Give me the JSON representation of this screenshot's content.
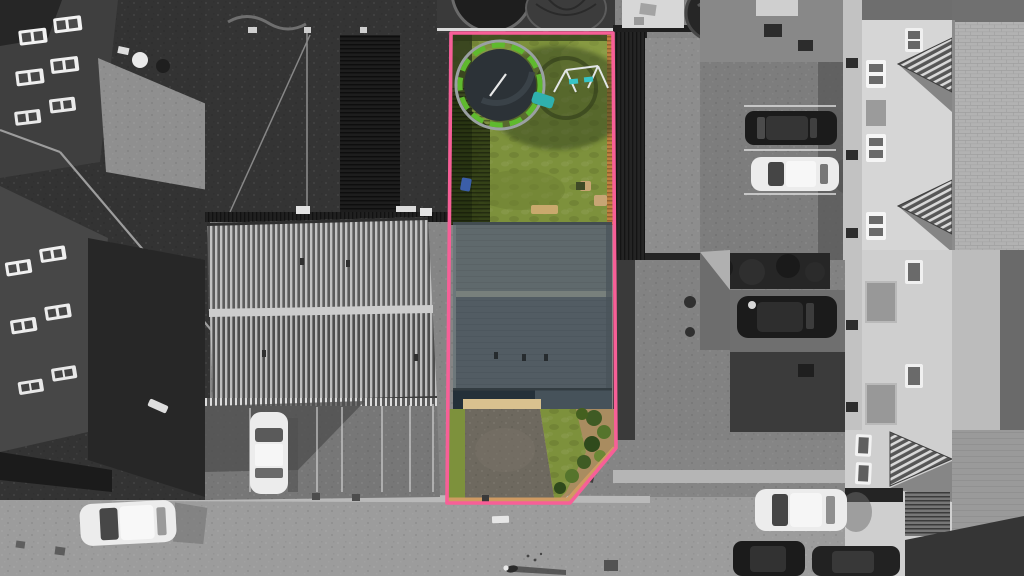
{
  "meta": {
    "kind": "aerial-drone-photograph",
    "description": "Overhead estate-agent style drone photo of a terraced property; the subject plot is outlined in pink and shown in colour while all surroundings are desaturated greyscale.",
    "visible_text": ""
  },
  "scene": {
    "elements": [
      "pink property boundary outline with bevelled front corner",
      "green rear lawn with trampoline, toy slide and swing set",
      "slate grey pitched house roof with three roof vents",
      "tarmac driveway flanked by grass and a shrub bed with tan brick edging",
      "large corrugated-roof outbuilding left of plot",
      "neighbouring grey lawn, decking and hot tub right of plot",
      "parking bays with one dark and one white car (right)",
      "parking bays with white car under building shadow (left)",
      "gable-fronted houses with striped dormer roofs (right)",
      "dark brick houses with white windows (left)",
      "bottom road with two white cars, two dark cars, manhole and a pedestrian casting a long shadow",
      "timber fences and their slatted shadows"
    ],
    "cars": {
      "white": 4,
      "dark": 4
    },
    "pedestrians": 1
  },
  "colors": {
    "boundary": "#f75f97",
    "lawn": "#7d913c",
    "lawn_shadow": "#3f4a24",
    "trampoline_rim": "#5fb92e",
    "trampoline_mat": "#2c3237",
    "trampoline_ring": "#9aa0a2",
    "slide_teal": "#2fb0ae",
    "swing_frame": "#e2e6e7",
    "swing_seat": "#38c4c6",
    "roof_upper": "#5f696c",
    "roof_lower": "#525c63",
    "roof_ridge": "#78807c",
    "driveway": "#6e695f",
    "paving_tan": "#d9c18f",
    "edging_tan": "#cf9a62",
    "soil": "#a98c60",
    "shrub_dark": "#3f5b24",
    "shrub_light": "#6c8836",
    "fence_orange": "#c0803f",
    "blue_bin": "#3b5ea8",
    "mono_bg": "#858585",
    "mono_dark": "#2a2a2a",
    "mono_road": "#9c9c9c",
    "white_car": "#ececec",
    "dark_car": "#1b1b1b"
  }
}
